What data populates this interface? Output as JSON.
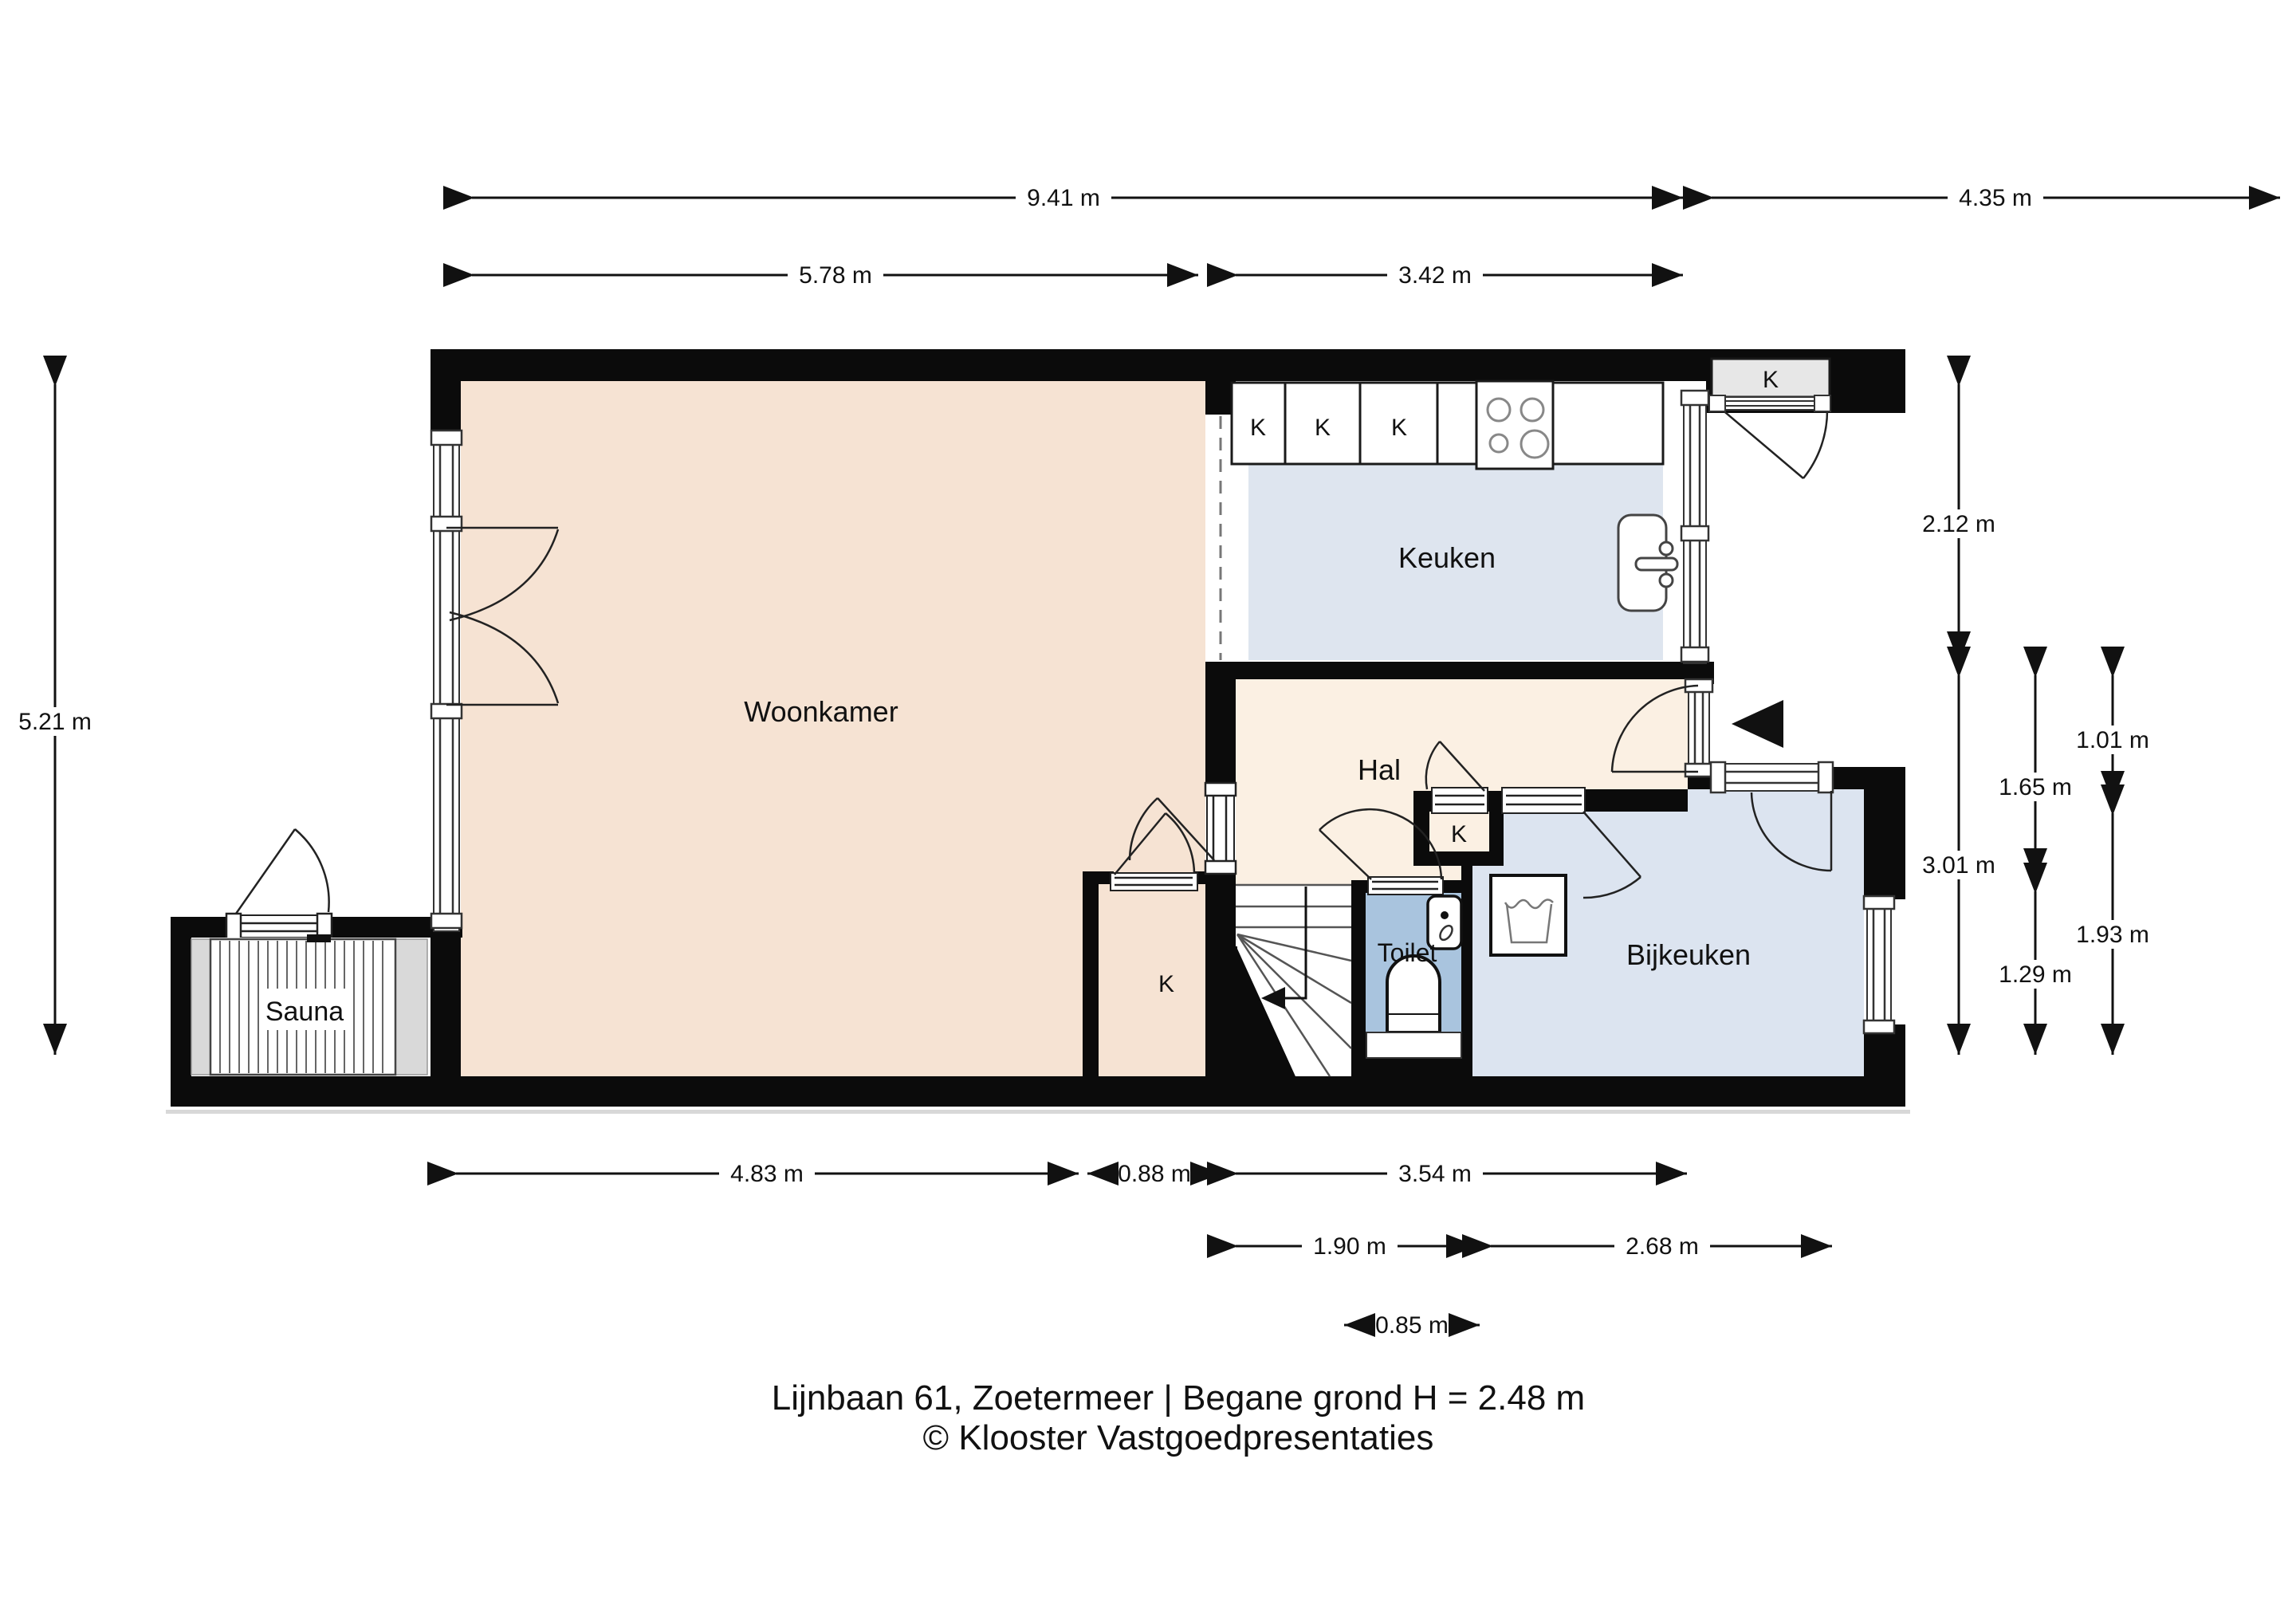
{
  "footer": {
    "line1": "Lijnbaan 61, Zoetermeer | Begane grond H = 2.48 m",
    "line2": "© Klooster Vastgoedpresentaties"
  },
  "rooms": {
    "woonkamer": "Woonkamer",
    "keuken": "Keuken",
    "hal": "Hal",
    "toilet": "Toilet",
    "bijkeuken": "Bijkeuken",
    "sauna": "Sauna",
    "k": "K"
  },
  "dimensions": {
    "top_total": "9.41 m",
    "top_right": "4.35 m",
    "top_living": "5.78 m",
    "top_kitchen": "3.42 m",
    "left_height": "5.21 m",
    "right_porch": "2.12 m",
    "right_lower": "3.01 m",
    "right_hall": "1.65 m",
    "right_toilet": "1.29 m",
    "right_small": "1.01 m",
    "right_utility": "1.93 m",
    "bottom_living": "4.83 m",
    "bottom_closet": "0.88 m",
    "bottom_right": "3.54 m",
    "bottom_stairs": "1.90 m",
    "bottom_utility": "2.68 m",
    "bottom_toilet": "0.85 m"
  },
  "colors": {
    "wall": "#0b0b0b",
    "living": "#f6e3d3",
    "hall": "#fbf0e3",
    "kitchen": "#dee5ef",
    "utility": "#dce4f0",
    "toilet": "#a9c4de",
    "closet": "#e7e7e7",
    "bench": "#d9d9d9",
    "line": "#1a1a1a"
  }
}
